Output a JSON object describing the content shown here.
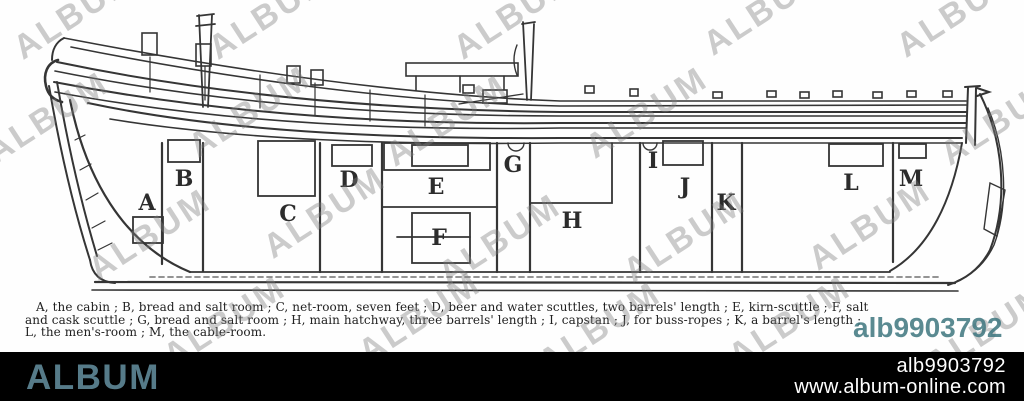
{
  "image_id": "alb9903792",
  "watermark_text": "ALBUM",
  "figure": {
    "labels": [
      "A",
      "B",
      "C",
      "D",
      "E",
      "F",
      "G",
      "H",
      "I",
      "J",
      "K",
      "L",
      "M"
    ],
    "caption": {
      "line1": "A, the cabin ;  B, bread and salt room ;  C, net-room, seven feet ;  D, beer and water scuttles, two barrels' length ;  E, kirn-scuttle ; F, salt",
      "line2": "and cask scuttle ;  G, bread and salt room ;  H, main hatchway, three barrels' length ;  I, capstan ; J, for buss-ropes ; K, a barrel's length ;",
      "line3": "L, the men's-room ; M, the cable-room."
    }
  },
  "footer": {
    "brand": "ALBUM",
    "website": "www.album-online.com"
  },
  "colors": {
    "brand_teal": "#567b89",
    "overlay_teal": "#3e767f",
    "footer_bg": "#000000",
    "ink": "#262626"
  }
}
